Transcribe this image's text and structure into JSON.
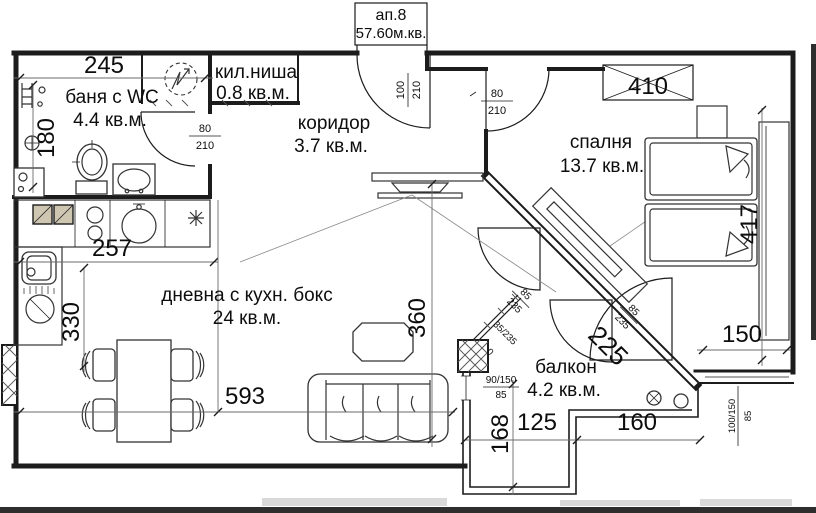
{
  "colors": {
    "line": "#1c1c1c",
    "dim": "#6b6b6b",
    "hatch": "#cfc6b2",
    "scan": "#2e2e2e"
  },
  "header": {
    "apartment": "ап.8",
    "total_area": "57.60м.кв."
  },
  "rooms": [
    {
      "name": "баня с WC",
      "area": "4.4 кв.м."
    },
    {
      "name": "кил.ниша",
      "area": "0.8 кв.м."
    },
    {
      "name": "коридор",
      "area": "3.7 кв.м."
    },
    {
      "name": "спалня",
      "area": "13.7 кв.м."
    },
    {
      "name": "дневна с кухн. бокс",
      "area": "24 кв.м."
    },
    {
      "name": "балкон",
      "area": "4.2 кв.м."
    }
  ],
  "dimensions": {
    "bath_width": "245",
    "bath_depth": "180",
    "kitchen_width": "257",
    "kitchen_depth": "330",
    "living_width": "593",
    "living_depth": "360",
    "bedroom_width": "410",
    "bedroom_depth": "417",
    "bedroom_recess": "150",
    "diagonal_wall": "225",
    "balcony_depth": "168",
    "balcony_left": "125",
    "balcony_right": "160"
  },
  "openings": {
    "entrance": {
      "w": "100",
      "h": "210"
    },
    "bath_door": {
      "w": "80",
      "h": "210"
    },
    "bedroom_door": {
      "w": "80",
      "h": "210"
    },
    "terrace_door_1": {
      "w": "85",
      "h": "235"
    },
    "terrace_door_2": {
      "w": "85",
      "h": "235"
    },
    "side_window": {
      "wh": "35/235",
      "sill": "0"
    },
    "balcony_window": {
      "w": "90/150",
      "sill": "85"
    },
    "south_window": {
      "w": "100/150",
      "sill": "85"
    }
  }
}
